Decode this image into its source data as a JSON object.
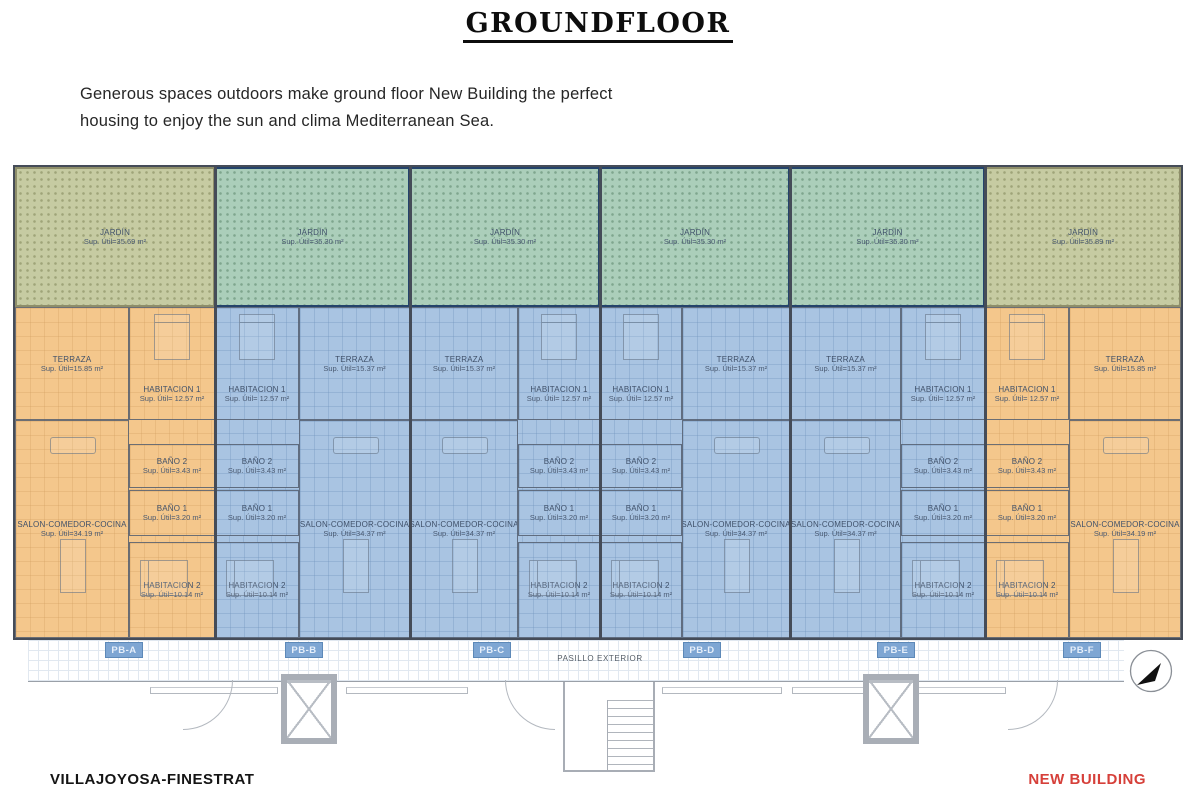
{
  "title": "GROUNDFLOOR",
  "description": {
    "line1": "Generous spaces outdoors make ground floor New Building the perfect",
    "line2": "housing to enjoy the sun and clima Mediterranean Sea."
  },
  "footer": {
    "left": "VILLAJOYOSA-FINESTRAT",
    "right": "NEW BUILDING",
    "right_color": "#d6403a"
  },
  "plan": {
    "pasillo_label": "PASILLO EXTERIOR",
    "colors": {
      "orange_unit": "#f4c78c",
      "blue_unit": "#a9c4e2",
      "jardin_on_orange": "#c6cba2",
      "jardin_on_blue": "#abceba",
      "navy_border": "#24436b",
      "wall": "#454c58",
      "unit_tag_bg": "#7ea6d3"
    },
    "units": [
      {
        "id": "PB-A",
        "type": "orange",
        "rooms": {
          "jardin": {
            "name": "JARDÍN",
            "area": "Sup. Útil=35.69 m²"
          },
          "terraza": {
            "name": "TERRAZA",
            "area": "Sup. Útil=15.85 m²"
          },
          "habitacion1": {
            "name": "HABITACION 1",
            "area": "Sup. Útil= 12.57 m²"
          },
          "bano2": {
            "name": "BAÑO 2",
            "area": "Sup. Útil=3.43 m²"
          },
          "bano1": {
            "name": "BAÑO 1",
            "area": "Sup. Útil=3.20 m²"
          },
          "salon": {
            "name": "SALON-COMEDOR-COCINA",
            "area": "Sup. Útil=34.19 m²"
          },
          "habitacion2": {
            "name": "HABITACION 2",
            "area": "Sup. Útil=10.14 m²"
          }
        }
      },
      {
        "id": "PB-B",
        "type": "blue",
        "rooms": {
          "jardin": {
            "name": "JARDÍN",
            "area": "Sup. Útil=35.30 m²"
          },
          "terraza": {
            "name": "TERRAZA",
            "area": "Sup. Útil=15.37 m²"
          },
          "habitacion1": {
            "name": "HABITACION 1",
            "area": "Sup. Útil= 12.57 m²"
          },
          "bano2": {
            "name": "BAÑO 2",
            "area": "Sup. Útil=3.43 m²"
          },
          "bano1": {
            "name": "BAÑO 1",
            "area": "Sup. Útil=3.20 m²"
          },
          "salon": {
            "name": "SALON-COMEDOR-COCINA",
            "area": "Sup. Útil=34.37 m²"
          },
          "habitacion2": {
            "name": "HABITACION 2",
            "area": "Sup. Útil=10.14 m²"
          }
        }
      },
      {
        "id": "PB-C",
        "type": "blue",
        "rooms": {
          "jardin": {
            "name": "JARDÍN",
            "area": "Sup. Útil=35.30 m²"
          },
          "terraza": {
            "name": "TERRAZA",
            "area": "Sup. Útil=15.37 m²"
          },
          "habitacion1": {
            "name": "HABITACION 1",
            "area": "Sup. Útil= 12.57 m²"
          },
          "bano2": {
            "name": "BAÑO 2",
            "area": "Sup. Útil=3.43 m²"
          },
          "bano1": {
            "name": "BAÑO 1",
            "area": "Sup. Útil=3.20 m²"
          },
          "salon": {
            "name": "SALON-COMEDOR-COCINA",
            "area": "Sup. Útil=34.37 m²"
          },
          "habitacion2": {
            "name": "HABITACION 2",
            "area": "Sup. Útil=10.14 m²"
          }
        }
      },
      {
        "id": "PB-D",
        "type": "blue",
        "rooms": {
          "jardin": {
            "name": "JARDÍN",
            "area": "Sup. Útil=35.30 m²"
          },
          "terraza": {
            "name": "TERRAZA",
            "area": "Sup. Útil=15.37 m²"
          },
          "habitacion1": {
            "name": "HABITACION 1",
            "area": "Sup. Útil= 12.57 m²"
          },
          "bano2": {
            "name": "BAÑO 2",
            "area": "Sup. Útil=3.43 m²"
          },
          "bano1": {
            "name": "BAÑO 1",
            "area": "Sup. Útil=3.20 m²"
          },
          "salon": {
            "name": "SALON-COMEDOR-COCINA",
            "area": "Sup. Útil=34.37 m²"
          },
          "habitacion2": {
            "name": "HABITACION 2",
            "area": "Sup. Útil=10.14 m²"
          }
        }
      },
      {
        "id": "PB-E",
        "type": "blue",
        "rooms": {
          "jardin": {
            "name": "JARDÍN",
            "area": "Sup. Útil=35.30 m²"
          },
          "terraza": {
            "name": "TERRAZA",
            "area": "Sup. Útil=15.37 m²"
          },
          "habitacion1": {
            "name": "HABITACION 1",
            "area": "Sup. Útil= 12.57 m²"
          },
          "bano2": {
            "name": "BAÑO 2",
            "area": "Sup. Útil=3.43 m²"
          },
          "bano1": {
            "name": "BAÑO 1",
            "area": "Sup. Útil=3.20 m²"
          },
          "salon": {
            "name": "SALON-COMEDOR-COCINA",
            "area": "Sup. Útil=34.37 m²"
          },
          "habitacion2": {
            "name": "HABITACION 2",
            "area": "Sup. Útil=10.14 m²"
          }
        }
      },
      {
        "id": "PB-F",
        "type": "orange",
        "rooms": {
          "jardin": {
            "name": "JARDÍN",
            "area": "Sup. Útil=35.89 m²"
          },
          "terraza": {
            "name": "TERRAZA",
            "area": "Sup. Útil=15.85 m²"
          },
          "habitacion1": {
            "name": "HABITACION 1",
            "area": "Sup. Útil= 12.57 m²"
          },
          "bano2": {
            "name": "BAÑO 2",
            "area": "Sup. Útil=3.43 m²"
          },
          "bano1": {
            "name": "BAÑO 1",
            "area": "Sup. Útil=3.20 m²"
          },
          "salon": {
            "name": "SALON-COMEDOR-COCINA",
            "area": "Sup. Útil=34.19 m²"
          },
          "habitacion2": {
            "name": "HABITACION 2",
            "area": "Sup. Útil=10.14 m²"
          }
        }
      }
    ]
  }
}
